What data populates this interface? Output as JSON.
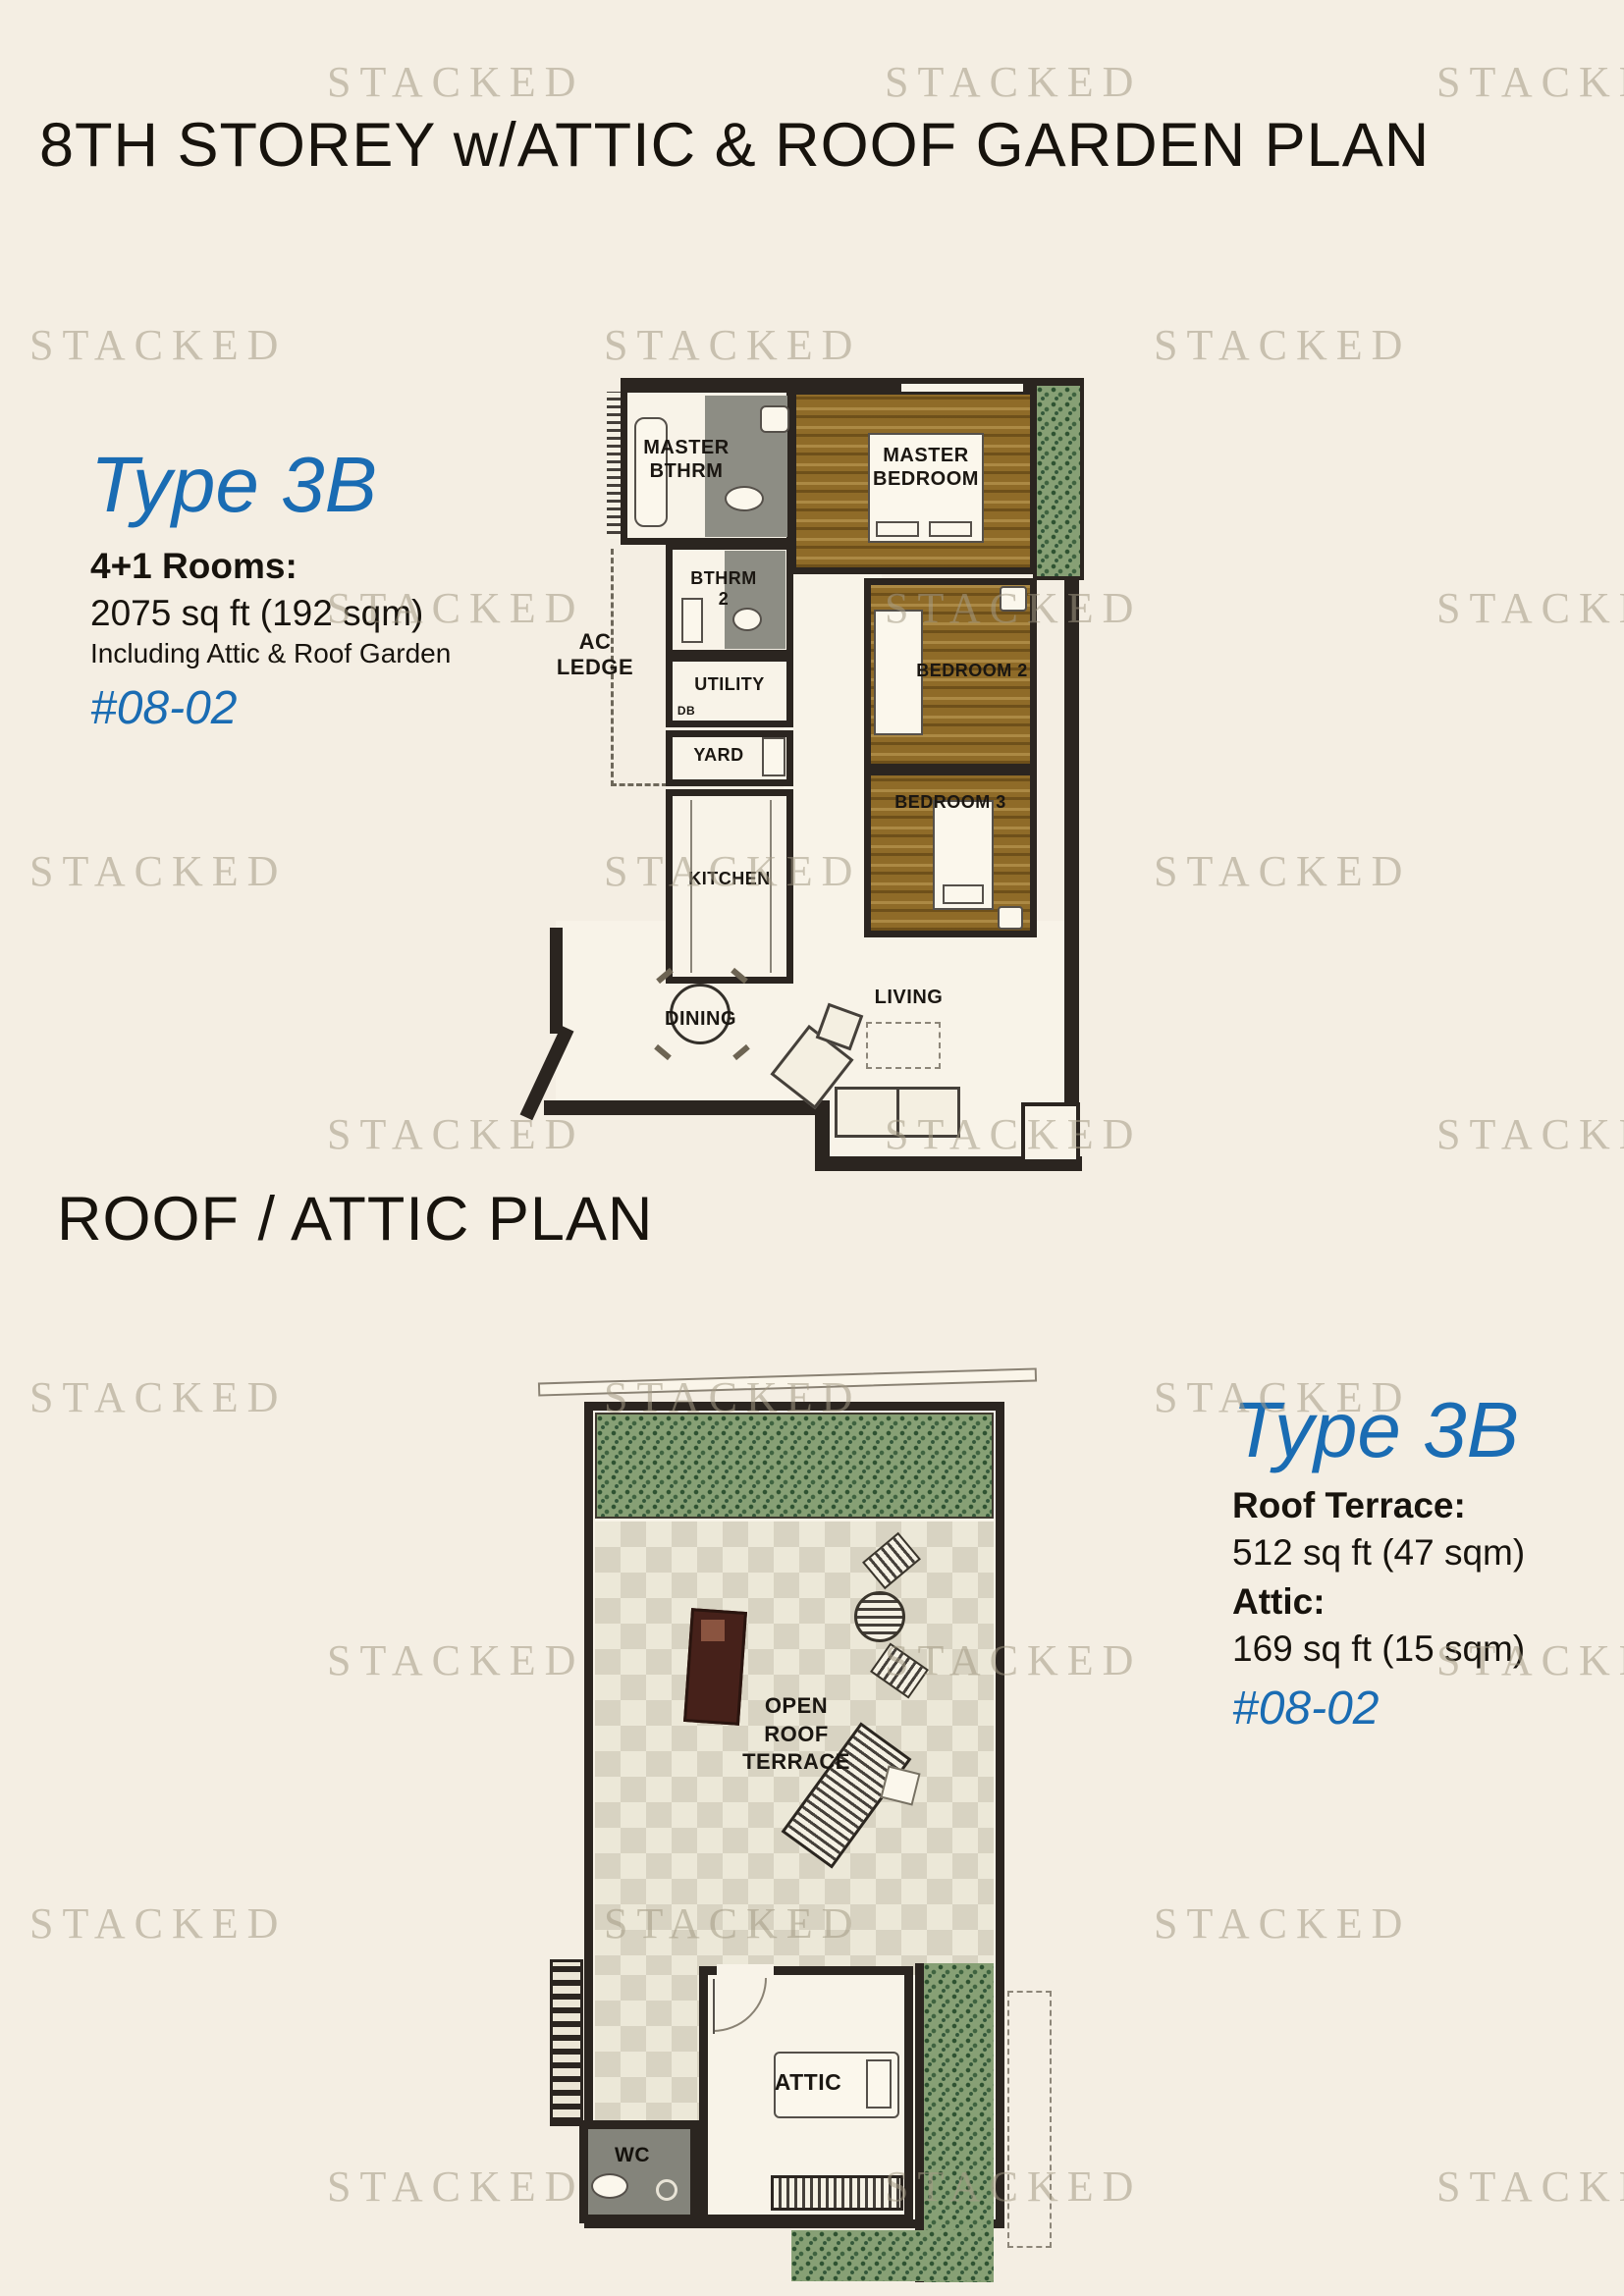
{
  "page": {
    "title": "8TH STOREY w/ATTIC & ROOF GARDEN PLAN",
    "roof_section_title": "ROOF / ATTIC PLAN",
    "watermark_text": "STACKED"
  },
  "colors": {
    "background": "#f4eee3",
    "accent_blue": "#1a6cb3",
    "ink": "#17130d",
    "wall": "#2b2520",
    "wood_floor": "#8f6b28",
    "planter_green": "#87a075",
    "bathroom_gray": "#8d8d84"
  },
  "unit_info_main": {
    "type_label": "Type 3B",
    "rooms_label": "4+1 Rooms:",
    "area": "2075 sq ft (192 sqm)",
    "note": "Including Attic & Roof Garden",
    "unit_number": "#08-02"
  },
  "unit_info_roof": {
    "type_label": "Type 3B",
    "roof_terrace_label": "Roof Terrace:",
    "roof_terrace_area": "512 sq ft (47 sqm)",
    "attic_label": "Attic:",
    "attic_area": "169 sq ft (15 sqm)",
    "unit_number": "#08-02"
  },
  "floor_plan_main": {
    "rooms": {
      "master_bthrm": "MASTER\nBTHRM",
      "master_bedroom": "MASTER\nBEDROOM",
      "bthrm_2": "BTHRM\n2",
      "ac_ledge": "AC\nLEDGE",
      "utility": "UTILITY",
      "db": "DB",
      "yard": "YARD",
      "kitchen": "KITCHEN",
      "bedroom_2": "BEDROOM 2",
      "bedroom_3": "BEDROOM 3",
      "dining": "DINING",
      "living": "LIVING"
    }
  },
  "floor_plan_roof": {
    "rooms": {
      "open_roof_terrace": "OPEN\nROOF\nTERRACE",
      "attic": "ATTIC",
      "wc": "WC"
    }
  }
}
